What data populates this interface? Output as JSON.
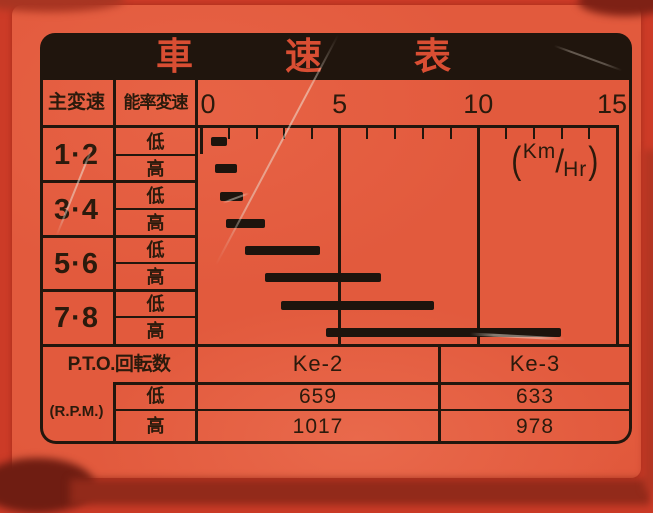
{
  "plate": {
    "title": "車速表",
    "header": {
      "main_shift": "主変速",
      "range_shift": "能率変速"
    },
    "speed_unit": {
      "open": "(",
      "numerator": "Km",
      "slash": "/",
      "denominator": "Hr",
      "close": ")"
    },
    "gear_rows": [
      {
        "gear": "1·2",
        "low": "低",
        "high": "高"
      },
      {
        "gear": "3·4",
        "low": "低",
        "high": "高"
      },
      {
        "gear": "5·6",
        "low": "低",
        "high": "高"
      },
      {
        "gear": "7·8",
        "low": "低",
        "high": "高"
      }
    ],
    "pto": {
      "header": "P.T.O.回転数",
      "unit": "(R.P.M.)",
      "low_label": "低",
      "high_label": "高",
      "columns": [
        {
          "name": "Ke-2",
          "low": "659",
          "high": "1017"
        },
        {
          "name": "Ke-3",
          "low": "633",
          "high": "978"
        }
      ]
    }
  },
  "chart_data": {
    "type": "bar",
    "orientation": "horizontal-range",
    "title": "車速表 (vehicle speed table)",
    "xlabel": "Km/Hr",
    "xlim": [
      0,
      15
    ],
    "x_ticks": [
      0,
      5,
      10,
      15
    ],
    "x_minor_tick_step": 1,
    "grid": "vertical gridlines at 5, 10, 15; ruler ticks below axis",
    "legend_position": "none",
    "categories": [
      "1·2 低",
      "1·2 高",
      "3·4 低",
      "3·4 高",
      "5·6 低",
      "5·6 高",
      "7·8 低",
      "7·8 高"
    ],
    "series": [
      {
        "name": "speed range (Km/Hr)",
        "ranges": [
          [
            0.35,
            0.95
          ],
          [
            0.5,
            1.3
          ],
          [
            0.7,
            1.5
          ],
          [
            0.9,
            2.3
          ],
          [
            1.6,
            4.3
          ],
          [
            2.3,
            6.5
          ],
          [
            2.9,
            8.4
          ],
          [
            4.5,
            13.0
          ]
        ]
      }
    ]
  }
}
